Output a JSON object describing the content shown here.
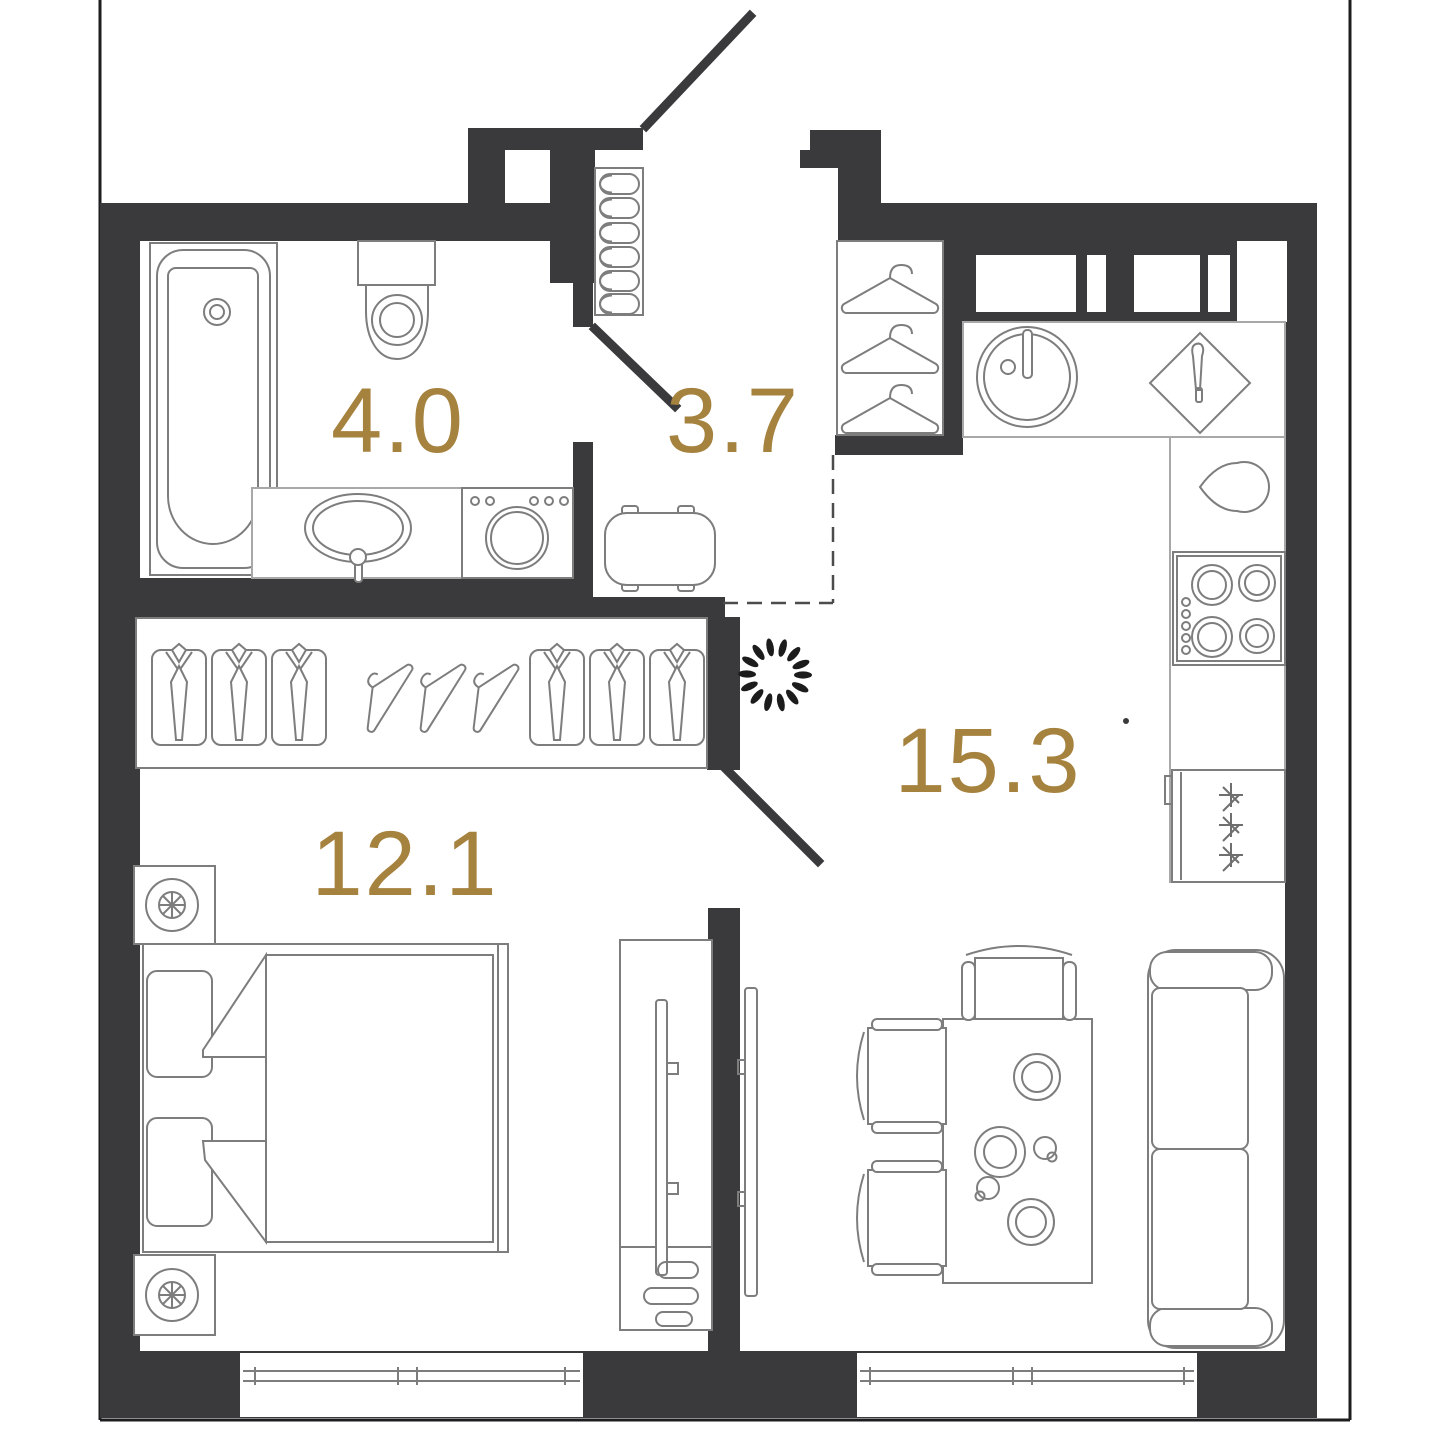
{
  "plan": {
    "type": "apartment-floor-plan",
    "units": "m2",
    "rooms": [
      {
        "id": "bathroom",
        "area_label": "4.0",
        "furniture": [
          "bathtub",
          "toilet",
          "vanity-sink",
          "washing-machine"
        ]
      },
      {
        "id": "hallway",
        "area_label": "3.7",
        "furniture": [
          "shoe-cabinet",
          "ottoman-bench",
          "wardrobe-hangers"
        ]
      },
      {
        "id": "kitchen-living",
        "area_label": "15.3",
        "furniture": [
          "kitchen-sink",
          "cutting-board",
          "kettle",
          "stove",
          "fridge",
          "dining-table",
          "chairs",
          "sofa",
          "tv-panel",
          "decorative-wreath"
        ]
      },
      {
        "id": "bedroom",
        "area_label": "12.1",
        "furniture": [
          "double-bed",
          "pillows",
          "blanket",
          "nightstand-lamp",
          "nightstand-lamp",
          "closet-shirts-hangers",
          "tv-stand"
        ]
      }
    ],
    "colors": {
      "wall": "#3a3a3c",
      "area_label": "#a6823f",
      "furniture_line": "#7d7d7d",
      "light_line": "#a8a8a8",
      "background": "#ffffff"
    },
    "doors": [
      "entrance-door",
      "bathroom-door",
      "bedroom-door"
    ],
    "windows_count": 4
  }
}
